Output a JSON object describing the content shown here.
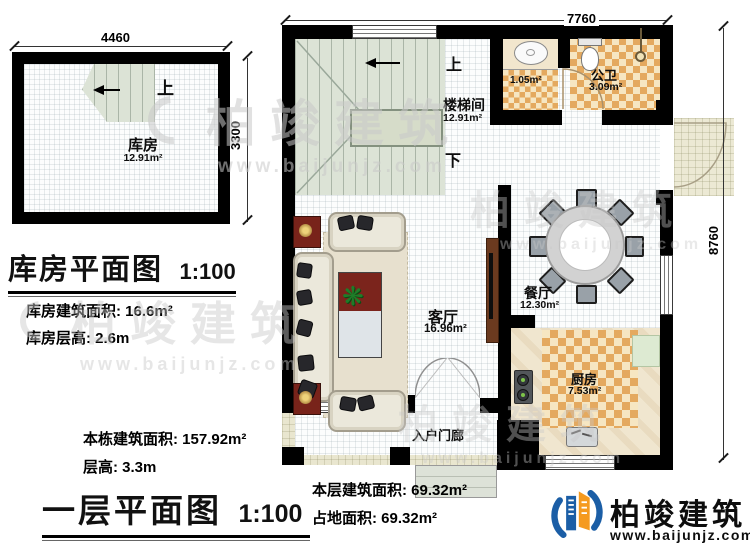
{
  "storage_plan": {
    "title": "库房平面图",
    "scale": "1:100",
    "dim_top": "4460",
    "dim_side": "3300",
    "room_name": "库房",
    "room_area": "12.91m²",
    "stair_up": "上",
    "note_area": "库房建筑面积: 16.6m²",
    "note_height": "库房层高: 2.6m"
  },
  "floor_plan": {
    "title": "一层平面图",
    "scale": "1:100",
    "dim_top": "7760",
    "dim_side": "8760",
    "stair_up": "上",
    "stair_down": "下",
    "rooms": {
      "stairwell": {
        "name": "楼梯间",
        "area": "12.91m²"
      },
      "bath": {
        "name": "公卫",
        "area": "3.09m²"
      },
      "alcove": {
        "area": "1.05m²"
      },
      "living": {
        "name": "客厅",
        "area": "16.96m²"
      },
      "dining": {
        "name": "餐厅",
        "area": "12.30m²"
      },
      "kitchen": {
        "name": "厨房",
        "area": "7.53m²"
      },
      "porch": {
        "name": "入户门廊"
      }
    },
    "note_building_area": "本栋建筑面积: 157.92m²",
    "note_height": "层高: 3.3m",
    "note_floor_area": "本层建筑面积: 69.32m²",
    "note_footprint": "占地面积: 69.32m²"
  },
  "watermark": {
    "text": "柏竣建筑",
    "url": "www.baijunjz.com"
  },
  "brand": {
    "name": "柏竣建筑",
    "url": "www.baijunjz.com"
  },
  "colors": {
    "wall": "#000000",
    "stair_floor": "#dce3d6",
    "tile_dark": "#e4a95f",
    "tile_light": "#f6e6c2",
    "porch_floor": "#e9e6cf",
    "logo_blue": "#1b5ea6",
    "logo_orange": "#f59a1f"
  }
}
